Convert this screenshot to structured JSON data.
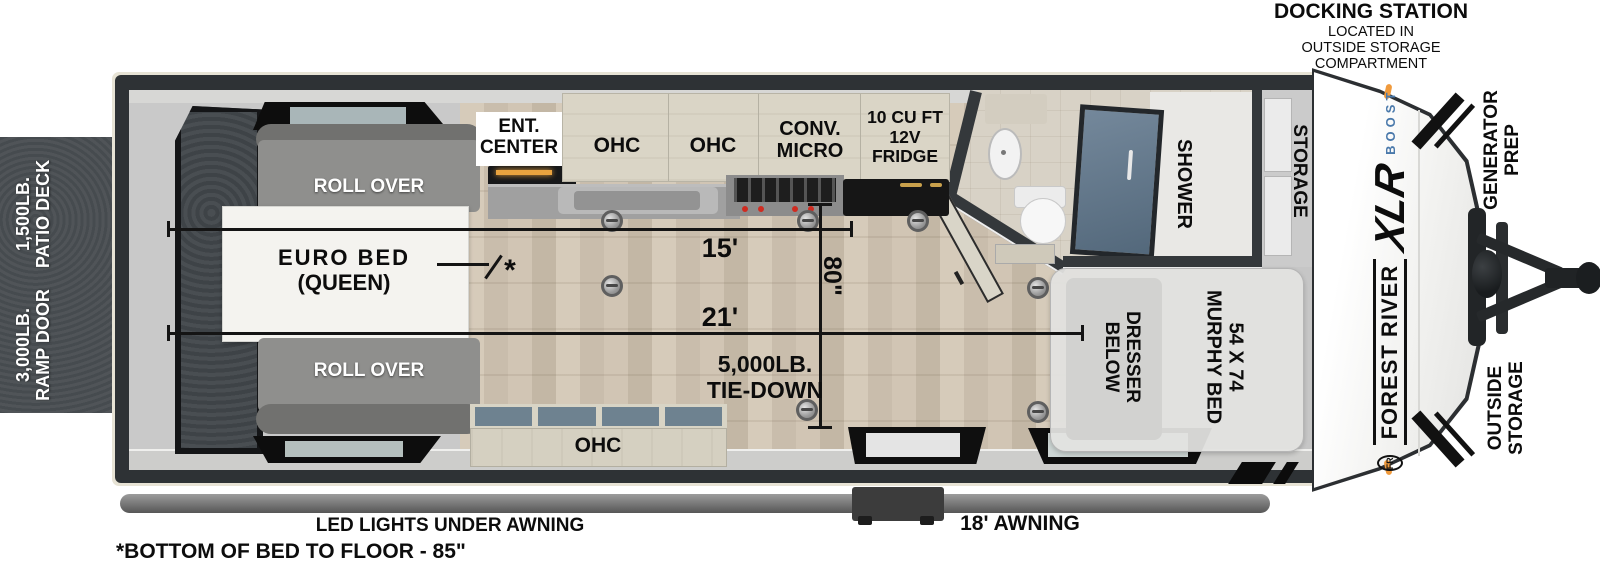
{
  "docking": {
    "title": "DOCKING STATION",
    "line1": "LOCATED IN",
    "line2": "OUTSIDE STORAGE",
    "line3": "COMPARTMENT"
  },
  "deck": {
    "patio_line1": "1,500LB.",
    "patio_line2": "PATIO DECK",
    "ramp_line1": "3,000LB.",
    "ramp_line2": "RAMP DOOR"
  },
  "garage": {
    "sofa_top": "ROLL OVER",
    "sofa_bottom": "ROLL OVER",
    "bed_line1": "EURO BED",
    "bed_line2": "(QUEEN)",
    "note_mark": "*"
  },
  "kitchen": {
    "ent_line1": "ENT.",
    "ent_line2": "CENTER",
    "ohc_left": "OHC",
    "ohc_right": "OHC",
    "micro_line1": "CONV.",
    "micro_line2": "MICRO",
    "fridge_line1": "10 CU FT",
    "fridge_line2": "12V",
    "fridge_line3": "FRIDGE",
    "ohc_bottom": "OHC"
  },
  "bathroom": {
    "shower": "SHOWER"
  },
  "front": {
    "storage": "STORAGE",
    "murphy_line1": "54 X 74",
    "murphy_line2": "MURPHY BED",
    "dresser_line1": "DRESSER",
    "dresser_line2": "BELOW"
  },
  "dimensions": {
    "length_kitchen": "15'",
    "length_main": "21'",
    "width": "80\"",
    "tiedown_line1": "5,000LB.",
    "tiedown_line2": "TIE-DOWN"
  },
  "exterior": {
    "generator_line1": "GENERATOR",
    "generator_line2": "PREP",
    "outside_line1": "OUTSIDE",
    "outside_line2": "STORAGE",
    "brand_crest": "FR",
    "brand_name": "FOREST RIVER",
    "brand_model": "XLR",
    "brand_sub": "BOOST"
  },
  "footer": {
    "led": "LED LIGHTS UNDER AWNING",
    "awning": "18' AWNING",
    "note": "*BOTTOM OF BED TO FLOOR - 85\""
  },
  "colors": {
    "wall": "#34383b",
    "trim": "#e7e3d5",
    "deck": "#4a4f53",
    "wood_floor": "#cdc1b0",
    "sofa": "#8f8f8d",
    "cabinet": "#dad5c6",
    "shower_glass": "#5d7386",
    "accent_orange": "#f09a3c",
    "boost_blue": "#4a79ab",
    "dim_line": "#141414"
  }
}
